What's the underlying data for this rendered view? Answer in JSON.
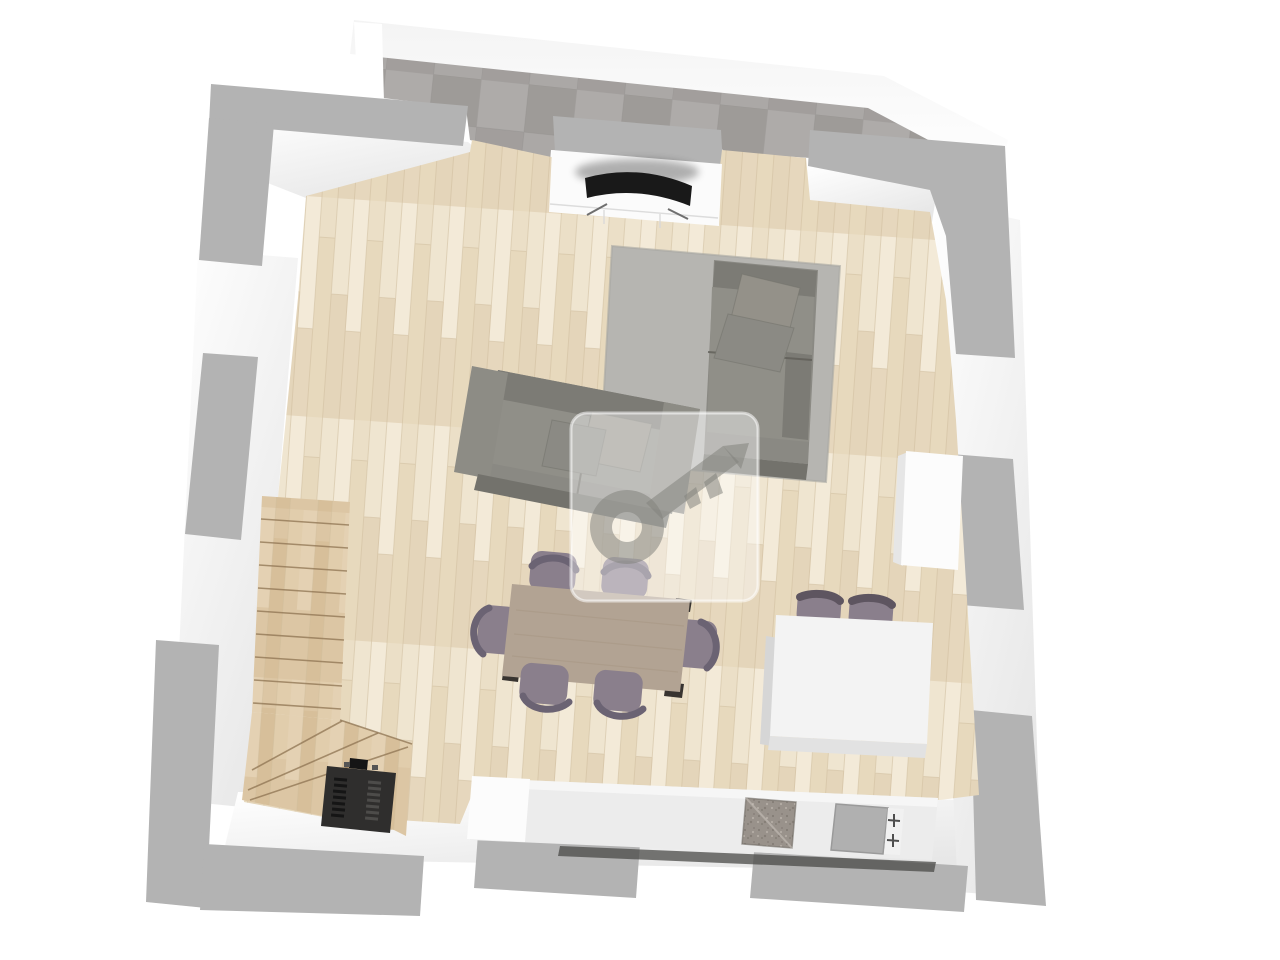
{
  "scene": {
    "type": "3d-floor-plan-top-view",
    "rooms": [
      "living-room",
      "kitchen",
      "terrace",
      "staircase"
    ],
    "furniture": [
      "corner-sofa-chaise",
      "two-seat-sofa",
      "throw-pillows",
      "area-rug",
      "tv-sideboard",
      "curved-tv",
      "dining-table",
      "dining-chair-x6",
      "kitchen-island",
      "bar-stool-x2",
      "kitchen-counter",
      "granite-sink",
      "cooktop-with-burners",
      "wood-burning-stove",
      "tall-cabinet",
      "staircase-with-winders"
    ],
    "watermark": "key-logo-badge"
  },
  "colors": {
    "bg": "#ffffff",
    "wall_gray": "#b3b3b3",
    "wall_white": "#ffffff",
    "concrete_base": "#a5a29f",
    "concrete_light": "#b6b3b0",
    "concrete_dark": "#959290",
    "concrete_line": "#8f8c89",
    "floor_base": "#ebdfc7",
    "floor_light": "#f4ecda",
    "floor_mid": "#e3d2b4",
    "floor_dark": "#d7c2a0",
    "floor_seam": "#cdbb9b",
    "stair_base": "#dcc6a4",
    "stair_light": "#e8d6ba",
    "stair_dark": "#d0b78f",
    "stair_line": "#8e7352",
    "rug": "#b6b5b1",
    "rug_edge": "#a7a6a2",
    "sofa_base": "#8a8983",
    "sofa_back": "#7c7b75",
    "sofa_seat": "#908f88",
    "sofa_arm": "#8d8c85",
    "sofa_side": "#73726c",
    "sofa_seam": "#5f5e58",
    "pillow": "#949189",
    "pillow_dark": "#8b8a84",
    "table": "#b2a393",
    "table_grain": "#a08f7b",
    "table_foot": "#383430",
    "chair_seat": "#8a7f8c",
    "chair_back": "#6b6373",
    "island": "#f3f3f3",
    "island_side": "#d6d6d6",
    "island_front": "#e2e2e2",
    "stool_seat": "#8a7f8c",
    "stool_back": "#5e5560",
    "cabinet": "#fcfcfc",
    "cabinet_side": "#e6e6e6",
    "counter": "#ececec",
    "counter_light": "#f8f8f8",
    "counter_shadow": "#4a4947",
    "sink_base": "#99928b",
    "sink_dark": "#7e7770",
    "sink_light": "#c4beb6",
    "cooktop": "#b0b0b0",
    "burner_panel": "#f1f1f1",
    "burner_cross": "#4e4e4e",
    "stove": "#2f2e2d",
    "stove_dark": "#151515",
    "stove_slat": "#4d4c4a",
    "tv": "#191919",
    "tv_stand": "#6f6f6f",
    "sideboard": "#fbfbfb",
    "watermark_fill": "#ffffff",
    "watermark_glyph": "#84837d"
  }
}
